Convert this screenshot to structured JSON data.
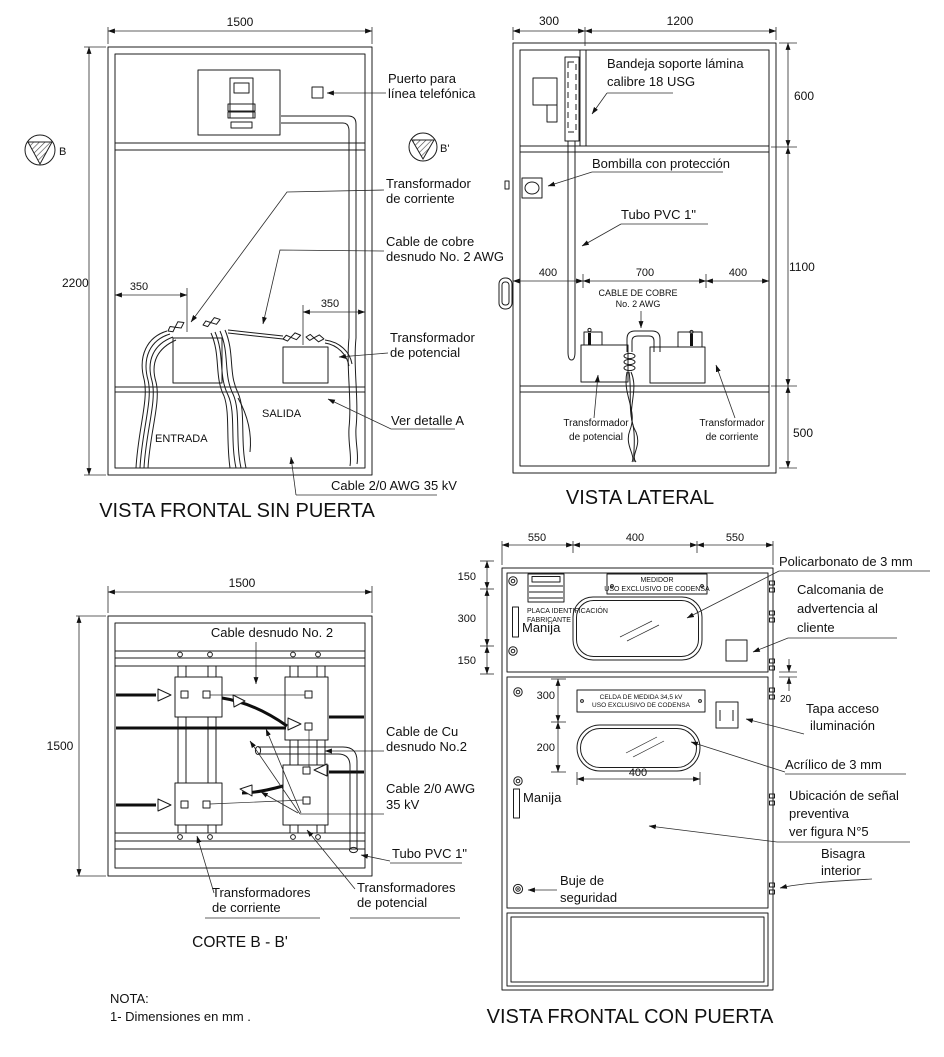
{
  "frontal_sin_puerta": {
    "title": "VISTA FRONTAL SIN PUERTA",
    "marker_left": "B",
    "marker_right": "B'",
    "dim_width": "1500",
    "dim_height": "2200",
    "dim_ct_offset": "350",
    "dim_pt_offset": "350",
    "entrada": "ENTRADA",
    "salida": "SALIDA",
    "puerto_1": "Puerto para",
    "puerto_2": "línea telefónica",
    "tc_1": "Transformador",
    "tc_2": "de corriente",
    "cobre_1": "Cable de cobre",
    "cobre_2": "desnudo No. 2 AWG",
    "tp_1": "Transformador",
    "tp_2": "de potencial",
    "detalle": "Ver detalle A",
    "cable20": "Cable 2/0 AWG 35 kV"
  },
  "lateral": {
    "title": "VISTA LATERAL",
    "dim_300": "300",
    "dim_1200": "1200",
    "dim_600": "600",
    "dim_1100": "1100",
    "dim_500": "500",
    "dim_400a": "400",
    "dim_700": "700",
    "dim_400b": "400",
    "bandeja_1": "Bandeja soporte lámina",
    "bandeja_2": "calibre 18 USG",
    "bombilla": "Bombilla con protección",
    "tubo": "Tubo PVC 1\"",
    "cable_1": "CABLE DE COBRE",
    "cable_2": "No. 2 AWG",
    "tp_1": "Transformador",
    "tp_2": "de potencial",
    "tc_1": "Transformador",
    "tc_2": "de corriente"
  },
  "corte": {
    "title": "CORTE B - B'",
    "dim_width": "1500",
    "dim_height": "1500",
    "cable_desnudo": "Cable desnudo No. 2",
    "cable_cu_1": "Cable de Cu",
    "cable_cu_2": "desnudo No.2",
    "cable20_1": "Cable 2/0 AWG",
    "cable20_2": "35 kV",
    "tubo": "Tubo PVC 1\"",
    "tc_1": "Transformadores",
    "tc_2": "de corriente",
    "tp_1": "Transformadores",
    "tp_2": "de potencial"
  },
  "con_puerta": {
    "title": "VISTA FRONTAL CON PUERTA",
    "dim_550a": "550",
    "dim_400": "400",
    "dim_550b": "550",
    "dim_150a": "150",
    "dim_300_left": "300",
    "dim_150b": "150",
    "dim_300": "300",
    "dim_200": "200",
    "dim_400w": "400",
    "dim_20": "20",
    "plate_medidor_1": "MEDIDOR",
    "plate_medidor_2": "USO EXCLUSIVO DE CODENSA",
    "placa_1": "PLACA IDENTIFICACIÓN",
    "placa_2": "FABRICANTE",
    "manija_1": "Manija",
    "manija_2": "Manija",
    "plate_celda_1": "CELDA DE MEDIDA 34,5 kV",
    "plate_celda_2": "USO EXCLUSIVO DE CODENSA",
    "policarbonato": "Policarbonato de 3 mm",
    "calcomania_1": "Calcomania de",
    "calcomania_2": "advertencia al",
    "calcomania_3": "cliente",
    "tapa_1": "Tapa acceso",
    "tapa_2": "iluminación",
    "acrilico": "Acrílico de 3 mm",
    "ubicacion_1": "Ubicación de señal",
    "ubicacion_2": "preventiva",
    "ubicacion_3": "ver figura N°5",
    "bisagra_1": "Bisagra",
    "bisagra_2": "interior",
    "buje_1": "Buje de",
    "buje_2": "seguridad"
  },
  "nota": {
    "line1": "NOTA:",
    "line2": "1- Dimensiones en mm ."
  }
}
